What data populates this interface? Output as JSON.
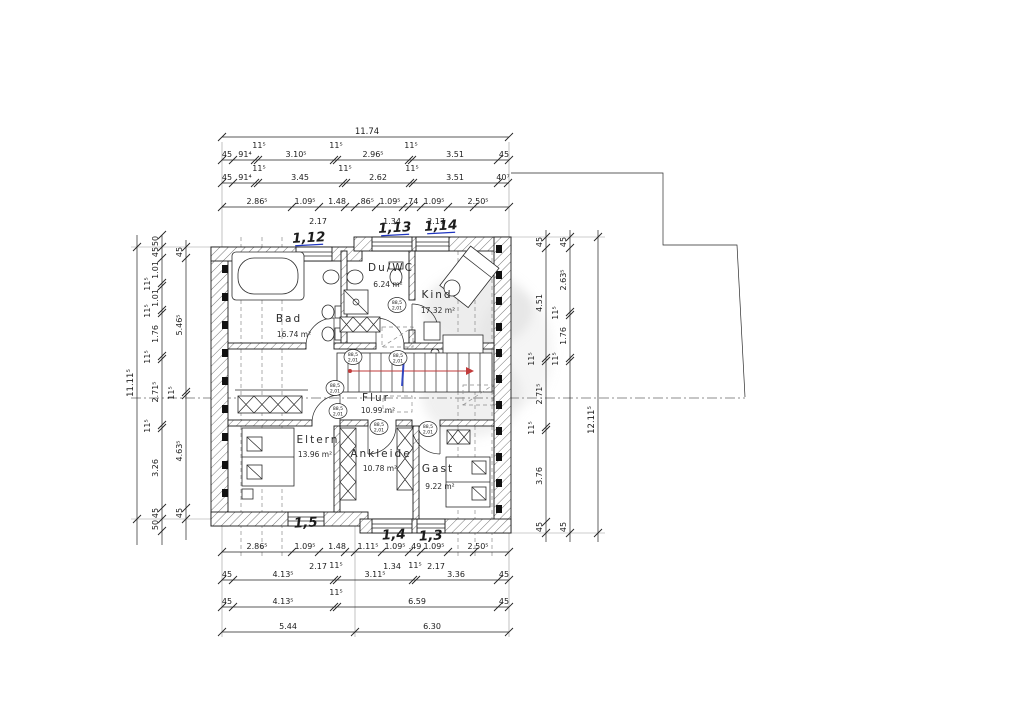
{
  "drawing_type": "floor plan (Dachgeschoss / upper floor), German residential plan",
  "colors": {
    "paper": "#ffffff",
    "line": "#1c1c1c",
    "annotation_blue": "#1f35c0",
    "stair_arrow_red": "#c23b3b",
    "hatch_grey": "#555555",
    "watermark_grey": "#bfbfbf"
  },
  "rooms": [
    {
      "name": "Bad",
      "area": "16.74 m²",
      "nx": 289,
      "ny": 322,
      "ax": 294,
      "ay": 337
    },
    {
      "name": "Du/WC",
      "area": "6.24 m²",
      "nx": 391,
      "ny": 271,
      "ax": 388,
      "ay": 287
    },
    {
      "name": "Kind",
      "area": "17.32 m²",
      "nx": 437,
      "ny": 298,
      "ax": 438,
      "ay": 313
    },
    {
      "name": "Flur",
      "area": "10.99 m²",
      "nx": 376,
      "ny": 401,
      "ax": 378,
      "ay": 413
    },
    {
      "name": "Eltern",
      "area": "13.96 m²",
      "nx": 318,
      "ny": 443,
      "ax": 315,
      "ay": 457
    },
    {
      "name": "Ankleide",
      "area": "10.78 m²",
      "nx": 381,
      "ny": 457,
      "ax": 380,
      "ay": 471
    },
    {
      "name": "Gast",
      "area": "9.22 m²",
      "nx": 438,
      "ny": 472,
      "ax": 440,
      "ay": 489
    }
  ],
  "blue_annotations": [
    {
      "t": "1,12",
      "x": 309,
      "y": 242,
      "u": 1
    },
    {
      "t": "1,13",
      "x": 395,
      "y": 232,
      "u": 1
    },
    {
      "t": "1,14",
      "x": 441,
      "y": 230,
      "u": 1
    },
    {
      "t": "1,5",
      "x": 306,
      "y": 527,
      "u": 0
    },
    {
      "t": "1,4",
      "x": 394,
      "y": 539,
      "u": 0
    },
    {
      "t": "1,3",
      "x": 431,
      "y": 540,
      "u": 0
    }
  ],
  "door_tags": {
    "top_line": "88,5",
    "bottom_line": "2,01",
    "positions": [
      {
        "x": 397,
        "y": 305
      },
      {
        "x": 353,
        "y": 357
      },
      {
        "x": 398,
        "y": 358
      },
      {
        "x": 335,
        "y": 388
      },
      {
        "x": 338,
        "y": 411
      },
      {
        "x": 379,
        "y": 427
      },
      {
        "x": 428,
        "y": 429
      }
    ]
  },
  "dimensions": {
    "chains": [
      {
        "id": "top-overall",
        "dir": "h",
        "pos": 137,
        "from": 222,
        "to": 509,
        "ticks": [
          222,
          509
        ],
        "labels": [
          {
            "t": "11.74",
            "p": 367
          }
        ]
      },
      {
        "id": "top-chain-2",
        "dir": "h",
        "pos": 160,
        "from": 222,
        "to": 509,
        "ticks": [
          222,
          233,
          255,
          258,
          334,
          337,
          409,
          412,
          498,
          509
        ],
        "labels": [
          {
            "t": "45",
            "p": 227
          },
          {
            "t": "91⁴",
            "p": 245
          },
          {
            "t": "11⁵",
            "p": 259,
            "o": -12
          },
          {
            "t": "3.10⁵",
            "p": 296
          },
          {
            "t": "11⁵",
            "p": 336,
            "o": -12
          },
          {
            "t": "2.96⁵",
            "p": 373
          },
          {
            "t": "11⁵",
            "p": 411,
            "o": -12
          },
          {
            "t": "3.51",
            "p": 455
          },
          {
            "t": "45",
            "p": 504
          }
        ]
      },
      {
        "id": "top-chain-3",
        "dir": "h",
        "pos": 183,
        "from": 222,
        "to": 509,
        "ticks": [
          222,
          233,
          255,
          258,
          343,
          346,
          410,
          413,
          498,
          508
        ],
        "labels": [
          {
            "t": "45",
            "p": 227
          },
          {
            "t": "91⁴",
            "p": 245
          },
          {
            "t": "11⁵",
            "p": 259,
            "o": -12
          },
          {
            "t": "3.45",
            "p": 300
          },
          {
            "t": "11⁵",
            "p": 345,
            "o": -12
          },
          {
            "t": "2.62",
            "p": 378
          },
          {
            "t": "11⁵",
            "p": 412,
            "o": -12
          },
          {
            "t": "3.51",
            "p": 455
          },
          {
            "t": "40⁷",
            "p": 503
          }
        ]
      },
      {
        "id": "top-chain-4",
        "dir": "h",
        "pos": 207,
        "from": 222,
        "to": 509,
        "ticks": [
          222,
          292,
          319,
          345,
          355,
          376,
          403,
          409,
          421,
          448,
          474,
          509
        ],
        "labels": [
          {
            "t": "2.86⁵",
            "p": 257
          },
          {
            "t": "1.09⁵",
            "p": 305
          },
          {
            "t": "1.48",
            "p": 337
          },
          {
            "t": ".86⁵",
            "p": 366
          },
          {
            "t": "1.09⁵",
            "p": 390
          },
          {
            "t": ".74",
            "p": 412
          },
          {
            "t": "1.09⁵",
            "p": 434
          },
          {
            "t": "2.50⁵",
            "p": 478
          },
          {
            "t": "2.17",
            "p": 318,
            "o": 10
          },
          {
            "t": "1.34",
            "p": 392,
            "o": 10
          },
          {
            "t": "2.17",
            "p": 436,
            "o": 10
          }
        ]
      },
      {
        "id": "bottom-chain-1",
        "dir": "h",
        "pos": 552,
        "from": 222,
        "to": 509,
        "ticks": [
          222,
          292,
          319,
          345,
          355,
          382,
          409,
          421,
          448,
          474,
          509
        ],
        "labels": [
          {
            "t": "2.86⁵",
            "p": 257
          },
          {
            "t": "1.09⁵",
            "p": 305
          },
          {
            "t": "1.48",
            "p": 337
          },
          {
            "t": "1.11⁵",
            "p": 368
          },
          {
            "t": "1.09⁵",
            "p": 395
          },
          {
            "t": ".49",
            "p": 415
          },
          {
            "t": "1.09⁵",
            "p": 434
          },
          {
            "t": "2.50⁵",
            "p": 478
          },
          {
            "t": "2.17",
            "p": 318,
            "o": 10
          },
          {
            "t": "1.34",
            "p": 392,
            "o": 10
          },
          {
            "t": "2.17",
            "p": 436,
            "o": 10
          }
        ]
      },
      {
        "id": "bottom-chain-2",
        "dir": "h",
        "pos": 580,
        "from": 222,
        "to": 509,
        "ticks": [
          222,
          233,
          334,
          337,
          413,
          416,
          498,
          509
        ],
        "labels": [
          {
            "t": "45",
            "p": 227
          },
          {
            "t": "4.13⁵",
            "p": 283
          },
          {
            "t": "11⁵",
            "p": 336,
            "o": -12
          },
          {
            "t": "3.11⁵",
            "p": 375
          },
          {
            "t": "11⁵",
            "p": 415,
            "o": -12
          },
          {
            "t": "3.36",
            "p": 456
          },
          {
            "t": "45",
            "p": 504
          }
        ]
      },
      {
        "id": "bottom-chain-3",
        "dir": "h",
        "pos": 607,
        "from": 222,
        "to": 509,
        "ticks": [
          222,
          233,
          334,
          337,
          498,
          509
        ],
        "labels": [
          {
            "t": "45",
            "p": 227
          },
          {
            "t": "4.13⁵",
            "p": 283
          },
          {
            "t": "11⁵",
            "p": 336,
            "o": -12
          },
          {
            "t": "6.59",
            "p": 417
          },
          {
            "t": "45",
            "p": 504
          }
        ]
      },
      {
        "id": "bottom-chain-4",
        "dir": "h",
        "pos": 632,
        "from": 222,
        "to": 509,
        "ticks": [
          222,
          355,
          509
        ],
        "labels": [
          {
            "t": "5.44",
            "p": 288
          },
          {
            "t": "6.30",
            "p": 432
          }
        ]
      },
      {
        "id": "left-overall",
        "dir": "v",
        "pos": 137,
        "from": 235,
        "to": 545,
        "ticks": [
          247,
          519
        ],
        "labels": [
          {
            "t": "11.11⁵",
            "p": 383
          }
        ]
      },
      {
        "id": "left-chain-2",
        "dir": "v",
        "pos": 162,
        "from": 235,
        "to": 545,
        "ticks": [
          235,
          247,
          258,
          283,
          286,
          310,
          313,
          356,
          359,
          425,
          428,
          508,
          519,
          531
        ],
        "labels": [
          {
            "t": "50",
            "p": 241
          },
          {
            "t": "45",
            "p": 252
          },
          {
            "t": "1.01",
            "p": 270
          },
          {
            "t": "11⁵",
            "p": 284,
            "o": -12
          },
          {
            "t": "1.01",
            "p": 298
          },
          {
            "t": "11⁵",
            "p": 311,
            "o": -12
          },
          {
            "t": "1.76",
            "p": 334
          },
          {
            "t": "11⁵",
            "p": 357,
            "o": -12
          },
          {
            "t": "2.71⁵",
            "p": 392
          },
          {
            "t": "11⁵",
            "p": 426,
            "o": -12
          },
          {
            "t": "3.26",
            "p": 468
          },
          {
            "t": "45",
            "p": 513
          },
          {
            "t": "50",
            "p": 525
          }
        ]
      },
      {
        "id": "left-chain-3",
        "dir": "v",
        "pos": 186,
        "from": 240,
        "to": 540,
        "ticks": [
          247,
          258,
          392,
          395,
          508,
          519
        ],
        "labels": [
          {
            "t": "45",
            "p": 252
          },
          {
            "t": "5.46⁵",
            "p": 325
          },
          {
            "t": "11⁵",
            "p": 393,
            "o": -12
          },
          {
            "t": "4.63⁵",
            "p": 451
          },
          {
            "t": "45",
            "p": 513
          }
        ]
      },
      {
        "id": "right-chain-1",
        "dir": "v",
        "pos": 546,
        "from": 230,
        "to": 542,
        "ticks": [
          237,
          248,
          358,
          361,
          427,
          430,
          522,
          533
        ],
        "labels": [
          {
            "t": "45",
            "p": 242
          },
          {
            "t": "4.51",
            "p": 303
          },
          {
            "t": "11⁵",
            "p": 359,
            "o": -12
          },
          {
            "t": "2.71⁵",
            "p": 394
          },
          {
            "t": "11⁵",
            "p": 428,
            "o": -12
          },
          {
            "t": "3.76",
            "p": 476
          },
          {
            "t": "45",
            "p": 527
          }
        ]
      },
      {
        "id": "right-chain-2",
        "dir": "v",
        "pos": 570,
        "from": 230,
        "to": 542,
        "ticks": [
          237,
          248,
          312,
          315,
          358,
          361,
          533
        ],
        "labels": [
          {
            "t": "45",
            "p": 242
          },
          {
            "t": "2.63⁵",
            "p": 280
          },
          {
            "t": "11⁵",
            "p": 313,
            "o": -12
          },
          {
            "t": "1.76",
            "p": 336
          },
          {
            "t": "11⁵",
            "p": 359,
            "o": -12
          },
          {
            "t": "45",
            "p": 527
          }
        ]
      },
      {
        "id": "right-overall",
        "dir": "v",
        "pos": 598,
        "from": 230,
        "to": 542,
        "ticks": [
          237,
          533
        ],
        "labels": [
          {
            "t": "12.11⁵",
            "p": 420
          }
        ]
      }
    ]
  }
}
